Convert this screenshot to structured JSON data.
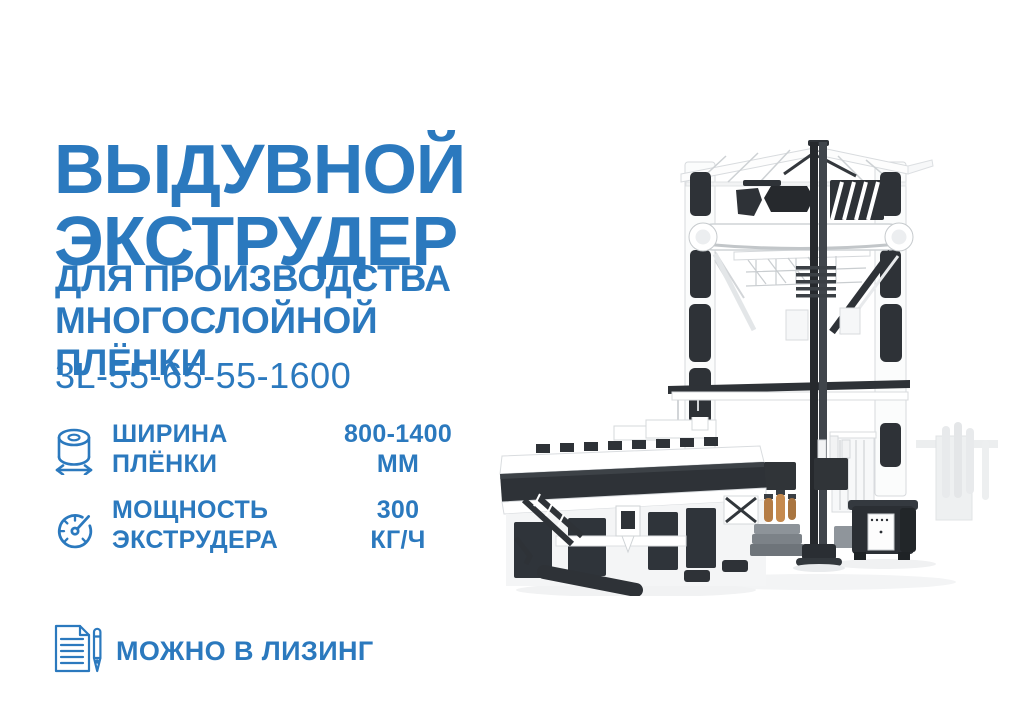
{
  "colors": {
    "accent": "#2b79be",
    "machine_dark": "#2e3237",
    "machine_accent_orange": "#bb8049"
  },
  "title": {
    "line1": "ВЫДУВНОЙ",
    "line2": "ЭКСТРУДЕР"
  },
  "subtitle": {
    "line1": "ДЛЯ ПРОИЗВОДСТВА",
    "line2": "МНОГОСЛОЙНОЙ",
    "line3": "ПЛЁНКИ"
  },
  "model": "3L-55-65-55-1600",
  "specs": [
    {
      "icon": "film-roll-width-icon",
      "label_line1": "ШИРИНА",
      "label_line2": "ПЛЁНКИ",
      "value_line1": "800-1400",
      "value_line2": "ММ"
    },
    {
      "icon": "speedometer-icon",
      "label_line1": "МОЩНОСТЬ",
      "label_line2": "ЭКСТРУДЕРА",
      "value_line1": "300",
      "value_line2": "КГ/Ч"
    }
  ],
  "leasing": {
    "icon": "document-pen-icon",
    "label": "МОЖНО В ЛИЗИНГ"
  },
  "machine": {
    "alt": "Промышленный выдувной экструдер для многослойной плёнки (монохромный 3D-рендер)"
  }
}
